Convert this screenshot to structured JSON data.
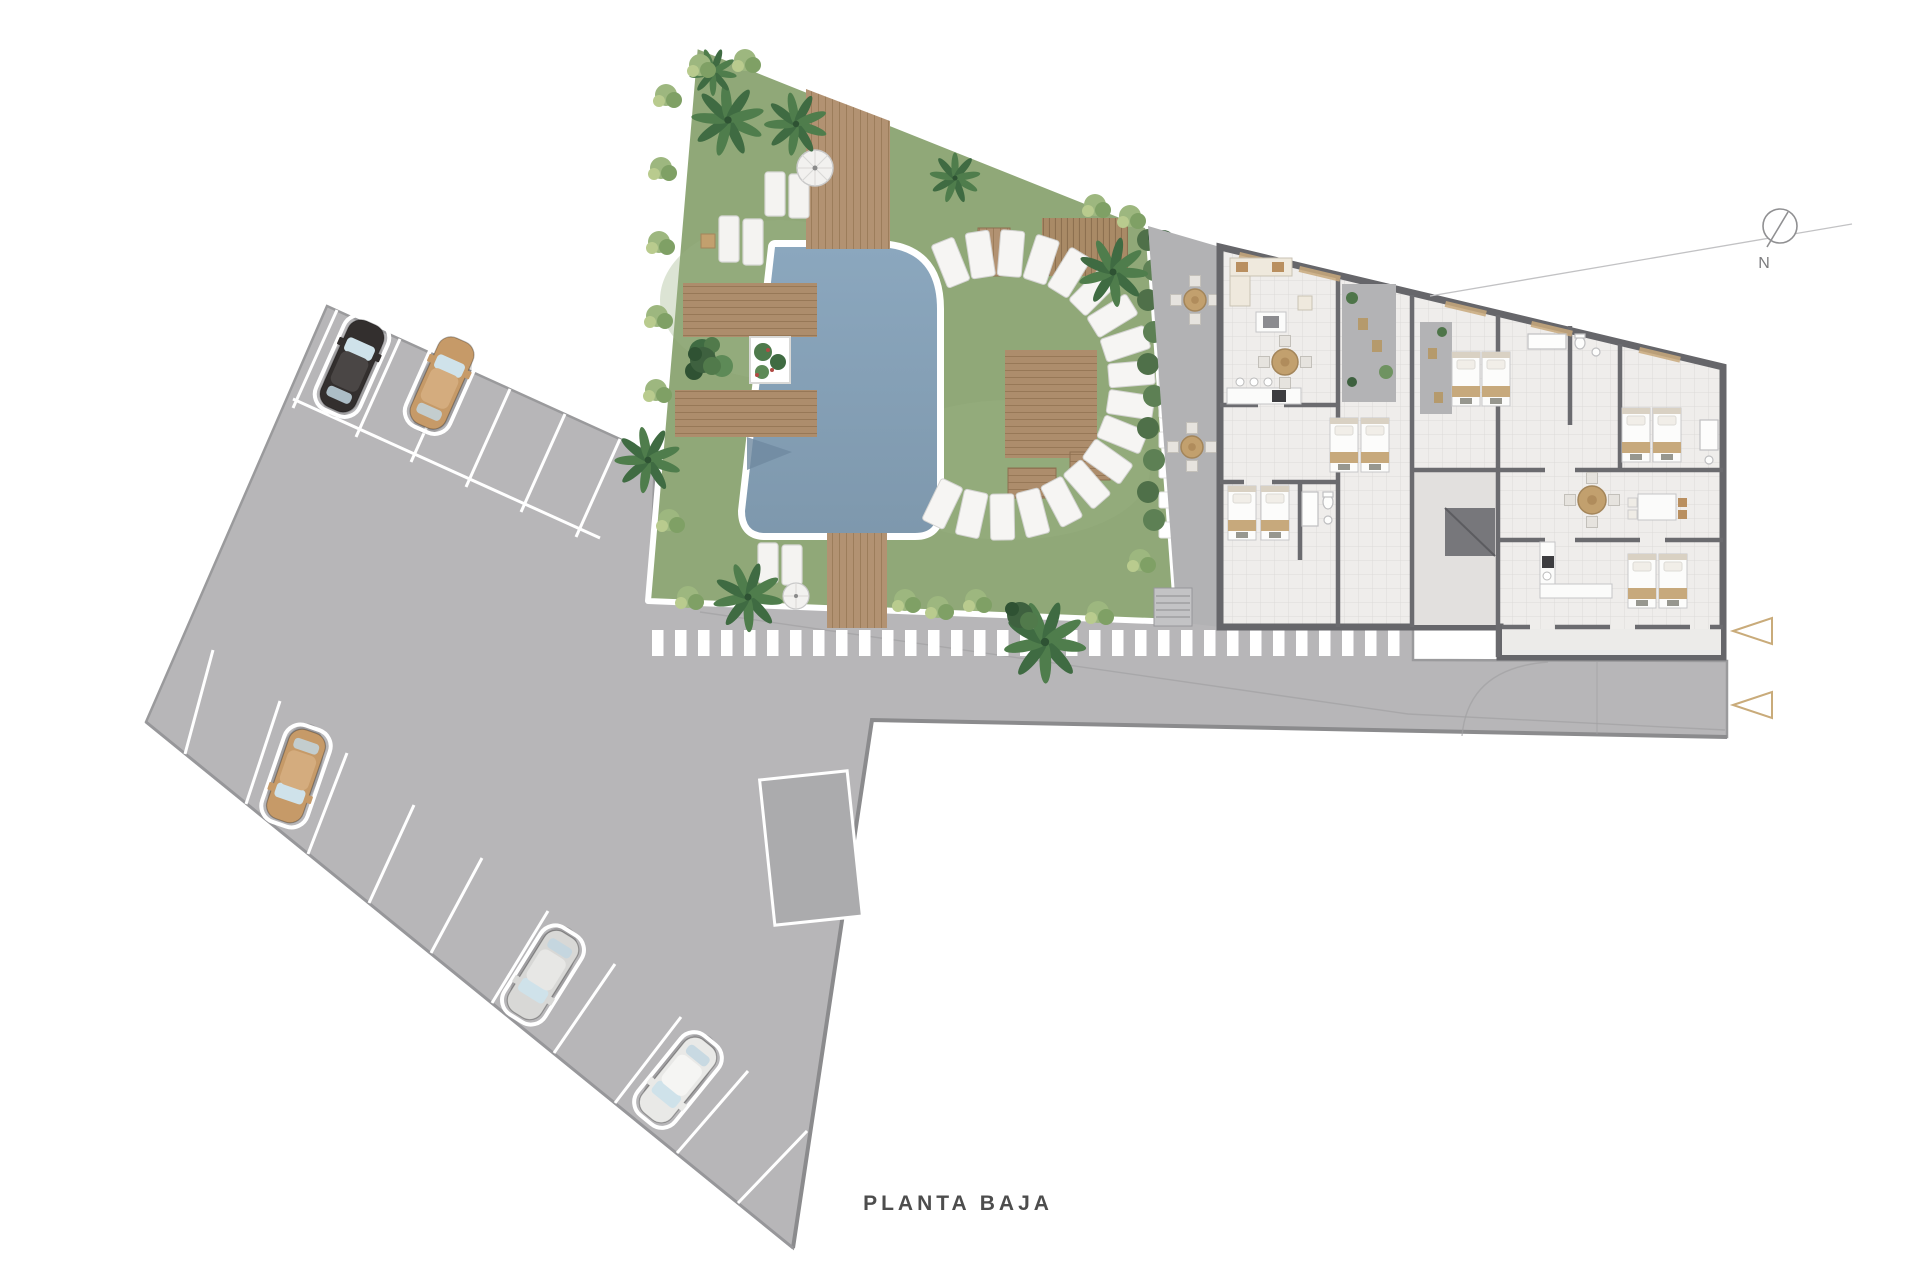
{
  "page": {
    "background": "#ffffff"
  },
  "title": {
    "label": "PLANTA BAJA",
    "color": "#4d4d4d"
  },
  "compass": {
    "label": "N"
  },
  "palette": {
    "ground": "#b7b6b8",
    "grass": "#90a878",
    "pool": "#84a0b8",
    "wood": "#b29272",
    "wall": "#66666a",
    "floor": "#efedeb",
    "accent_tan": "#c9ab7a",
    "paint": "#ffffff"
  },
  "scene": {
    "cars": [
      {
        "name": "black-car",
        "body": "#332f2e",
        "roof": "#4a4645",
        "x": 352,
        "y": 366,
        "rotation": 24
      },
      {
        "name": "tan-car-top",
        "body": "#c69a68",
        "roof": "#d4ac7e",
        "x": 442,
        "y": 383,
        "rotation": 24
      },
      {
        "name": "tan-car-left",
        "body": "#c69a68",
        "roof": "#d4ac7e",
        "x": 296,
        "y": 776,
        "rotation": 199
      },
      {
        "name": "silver-car",
        "body": "#d8d8d6",
        "roof": "#e7e7e5",
        "x": 543,
        "y": 975,
        "rotation": 212
      },
      {
        "name": "white-car",
        "body": "#e9e9e7",
        "roof": "#f5f5f3",
        "x": 678,
        "y": 1080,
        "rotation": 219
      }
    ],
    "entrance_arrows": [
      {
        "tip_x": 1733,
        "tip_y": 631
      },
      {
        "tip_x": 1733,
        "tip_y": 705
      }
    ],
    "arrow_style": {
      "length": 39,
      "half_height": 13,
      "stroke": "#c9ab7a"
    },
    "crosswalk": {
      "x": 652,
      "y": 630,
      "height": 26,
      "count": 33,
      "step": 23,
      "stripe_width": 11.5
    }
  }
}
